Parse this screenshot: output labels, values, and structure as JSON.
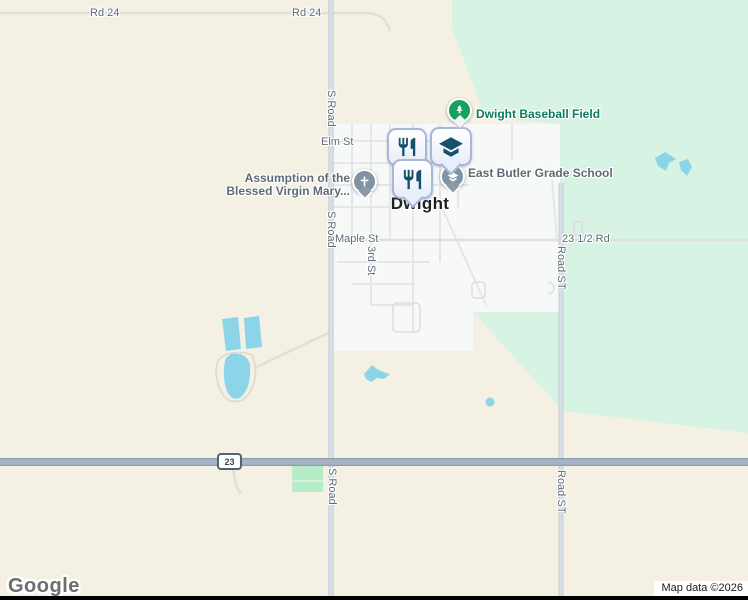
{
  "map_labels": {
    "rd_24": "Rd 24",
    "s_road": "S Road",
    "elm_st": "Elm St",
    "maple_st": "Maple St",
    "rd_23_half": "23 1/2 Rd",
    "third_st": "3rd St",
    "road_st": "Road ST",
    "town_name": "Dwight"
  },
  "highway": {
    "shield_number": "23"
  },
  "pois": {
    "baseball_field": {
      "label": "Dwight Baseball Field",
      "icon": "tree-icon",
      "pin_color": "#17a15f"
    },
    "grade_school": {
      "label": "East Butler Grade School",
      "icon": "school-icon"
    },
    "church": {
      "label_line1": "Assumption of the",
      "label_line2": "Blessed Virgin Mary...",
      "icon": "cross-icon",
      "pin_color": "#7f93a2"
    },
    "restaurants": {
      "icon": "restaurant-icon",
      "count": 2
    }
  },
  "attribution": {
    "logo": "Google",
    "map_data": "Map data ©2026"
  },
  "colors": {
    "rural_land": "#f4f0e4",
    "park_green": "#d7f3e3",
    "field_green": "#b7ecc9",
    "town": "#f7f8f8",
    "water": "#8cd5e9",
    "highway": "#a7b2c3",
    "street_label": "#5d6b76",
    "park_label": "#0e7a5d",
    "poi_label": "#5e6b74",
    "poi_glyph": "#17506b"
  }
}
